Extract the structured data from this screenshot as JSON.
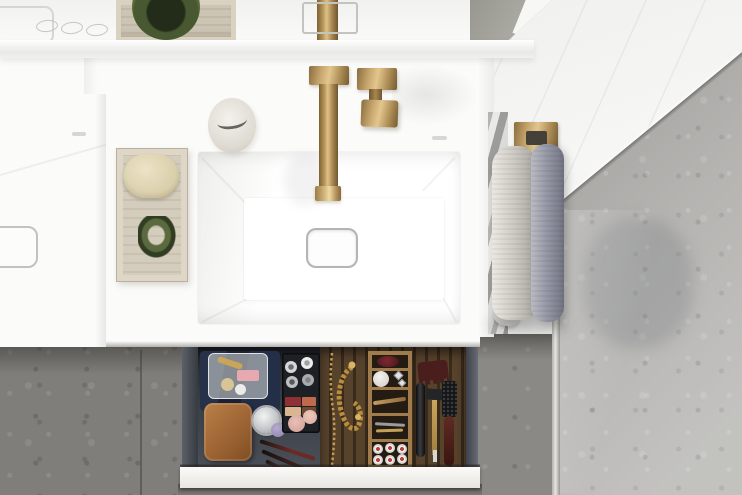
{
  "scene": {
    "description": "Top-down photograph of a bathroom vanity: two white rectangular washbasins with a brushed-brass wall-mounted tap, a travertine tray with a soap bar and green scrunchie, a white soap cup, a brass towel rail holding two towels beside a glass shower screen over grey stone flooring, and an open vanity drawer organised with cosmetics, jewellery and grooming tools.",
    "camera": "overhead",
    "labels": {
      "tile_wall": "white tiled wall",
      "shower_floor": "grey stone shower floor behind glass screen",
      "glass_screen": "glass shower screen edge",
      "floor": "grey terrazzo bathroom floor",
      "mirror_cabinet": "mirror cabinet top edge with three control buttons",
      "stone_box": "travertine box with green bowl on shelf",
      "faucet": "brushed-brass wall-mounted basin tap with square handle",
      "main_basin": "white rectangular washbasin with square chrome drain",
      "left_basin": "second white washbasin, partially visible",
      "tray": "travertine tray with soap bar and green scrunchie",
      "soap_cup": "white ceramic cup on counter",
      "towel_rail": "brass towel rail with light grey and blue-grey towels",
      "drawer": "open vanity drawer with organised contents",
      "drawer_front": "white drawer front panel"
    }
  },
  "palette": {
    "brass": "#b5945f",
    "brass_highlight": "#e2c68e",
    "ceramic_white": "#fbfbf9",
    "travertine": "#d4ccbc",
    "soap_cream": "#ddd1a9",
    "scrunchie_green": "#4a5a33",
    "towel_light": "#cfcbc5",
    "towel_blue_grey": "#989aa7",
    "floor_grey": "#7f7e7b",
    "shower_floor_grey": "#b5b4b1",
    "drawer_interior": "#3a3e45",
    "drawer_wood": "#57422c",
    "organizer_wood": "#a07c4c",
    "navy_cloth": "#1f2a40",
    "leather_pouch": "#a76f3e",
    "gold_chain": "#c19a4b"
  },
  "drawer_contents": [
    "navy velvet cloth",
    "transparent cosmetic bag with makeup",
    "tan leather pouch",
    "glass jar with ornate silver lid",
    "purple powder puff",
    "makeup brushes",
    "black tray with cream jars, eyeshadow quad and two blush compacts",
    "gold chain and bracelet",
    "wooden organizer with maroon item, white bath ball, silver jewellery, wooden stick, tweezers, hair pin and six small red-lidded jars",
    "hair claw clip",
    "black styling tool",
    "brass safety razor",
    "round hairbrush with dark red handle"
  ],
  "tray_items": [
    "cream soap bar",
    "green scrunchie"
  ],
  "towels": [
    {
      "position": "left",
      "color": "light grey"
    },
    {
      "position": "right",
      "color": "blue grey"
    }
  ],
  "counts": {
    "cabinet_buttons": 3,
    "organizer_compartments": 5,
    "small_jars": 6
  }
}
